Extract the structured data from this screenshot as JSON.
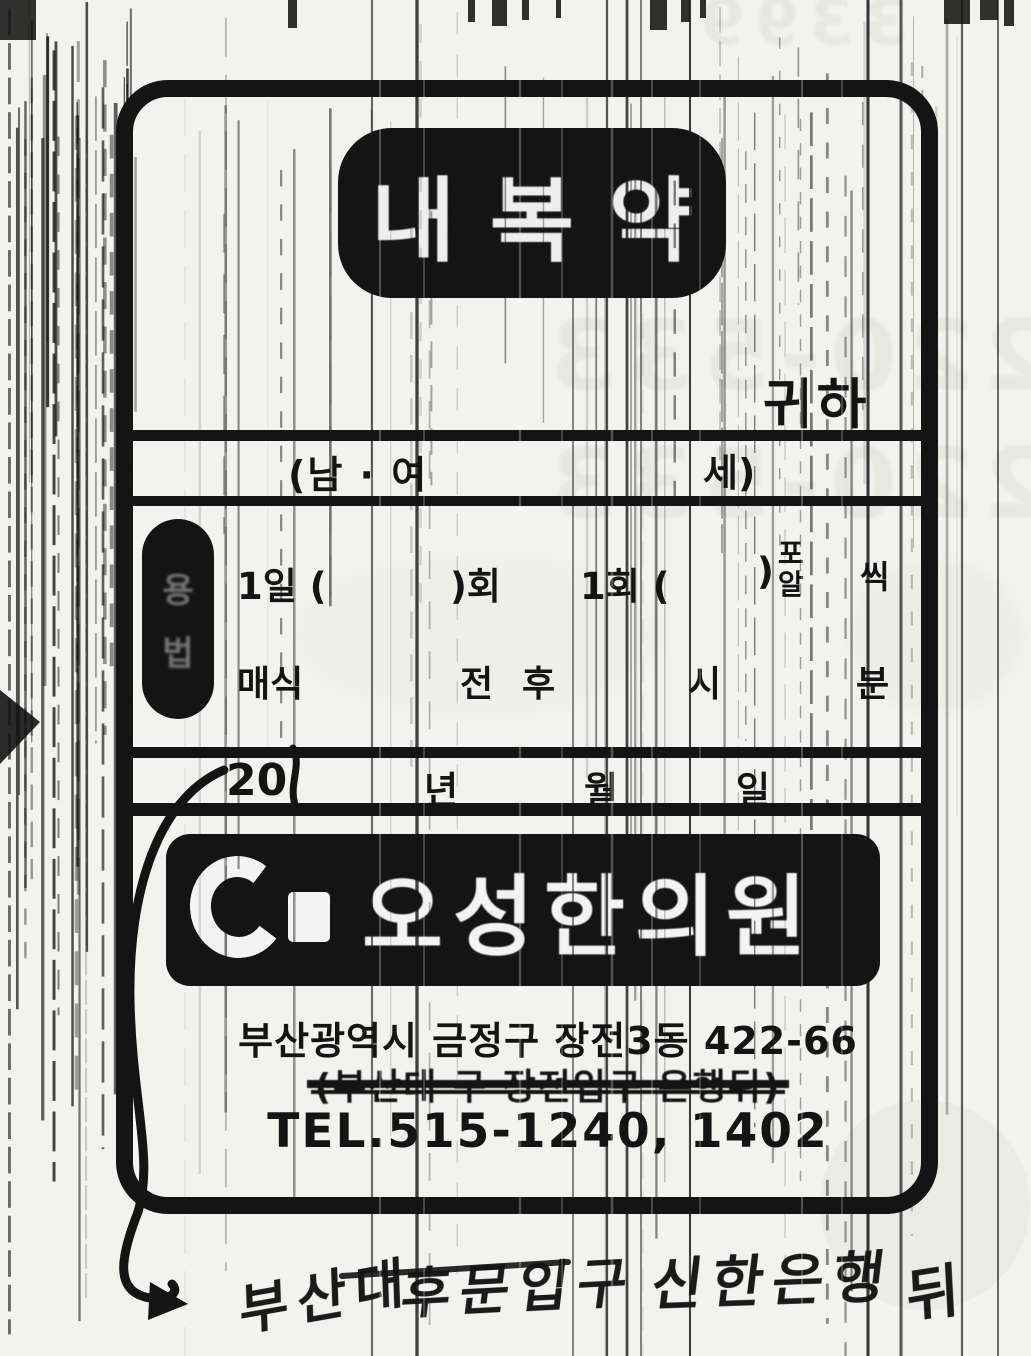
{
  "colors": {
    "paper": "#f2f2ee",
    "ink": "#141414",
    "ghost": "#e7e9e1"
  },
  "stamp": {
    "label": "내복약"
  },
  "header": {
    "honorific": "귀하"
  },
  "patient": {
    "gender_open": "(남 · 여",
    "age_close": "세)"
  },
  "usage": {
    "label_top": "용",
    "label_bottom": "법",
    "dose": {
      "per_day": "1일 (",
      "times": ")회",
      "per_time": "1회 (",
      "unit_close": ")",
      "unit_top": "포",
      "unit_bottom": "알",
      "each": "씩"
    },
    "meal": {
      "every_meal": "매식",
      "before": "전",
      "after": "후",
      "hour": "시",
      "minute": "분"
    }
  },
  "date": {
    "prefix": "20",
    "year": "년",
    "month": "월",
    "day": "일"
  },
  "clinic": {
    "name": "오성한의원",
    "address": "부산광역시 금정구 장전3동 422-66",
    "old_address": "(부산대  구 장전입구   은행뒤)",
    "tel": "TEL.515-1240, 1402"
  },
  "handwriting": {
    "w1": "부산대",
    "w2": "후문입구",
    "w3": "신한은행",
    "w4": "뒤"
  },
  "ghost": {
    "top_right": "3399",
    "mid1": "0220-533",
    "mid2": "0220-533"
  }
}
